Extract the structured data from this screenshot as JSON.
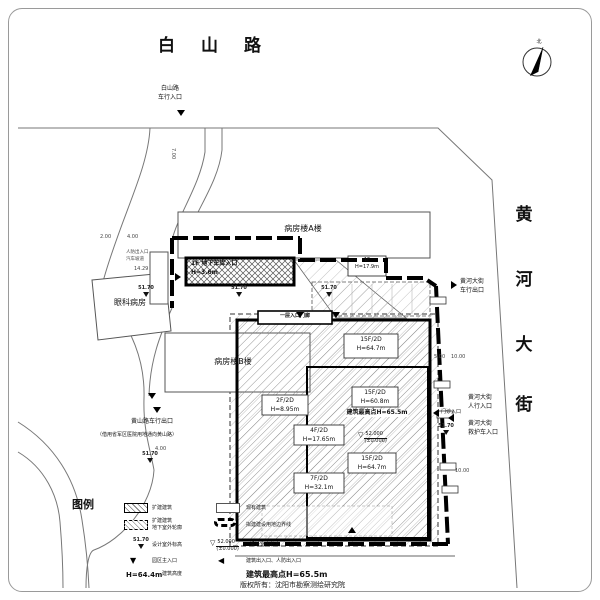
{
  "roads": {
    "baishan": "白山路",
    "huanghe": [
      "黄",
      "河",
      "大",
      "街"
    ]
  },
  "north": "北",
  "buildings": {
    "ward_a": "病房楼A楼",
    "ward_b": "病房楼B楼",
    "eye_ward": "眼科病房",
    "garage_l1": "1F 地下车库入口",
    "garage_l2": "H=3.6m",
    "podium_l1": "1F",
    "podium_l2": "H=17.9m",
    "porch": "一层入口门廊"
  },
  "annotations": {
    "t1": [
      "15F/2D",
      "H=64.7m"
    ],
    "t2": [
      "15F/2D",
      "H=60.8m",
      "建筑最高点H=65.5m"
    ],
    "t3": [
      "2F/2D",
      "H=8.95m"
    ],
    "t4": [
      "4F/2D",
      "H=17.65m"
    ],
    "t5": [
      "7F/2D",
      "H=32.1m"
    ],
    "t6": [
      "15F/2D",
      "H=64.7m"
    ]
  },
  "entrances": {
    "baishan_vehicle": [
      "白山路",
      "车行入口"
    ],
    "huanghe_exit": [
      "黄河大街",
      "车行出口"
    ],
    "outpatient": "门诊入口",
    "huanghe_ped": [
      "黄河大街",
      "人行入口"
    ],
    "huanghe_amb": [
      "黄河大街",
      "救护车入口"
    ],
    "huangshan_exit": "黄山路车行出口",
    "huangshan_note": "（借用省军区医院用地通向黄山路）"
  },
  "side_labels": {
    "ramp_l1": "人防出入口",
    "ramp_l2": "汽车坡道"
  },
  "indoor_mark": {
    "v1": "52.000",
    "v2": "(±0.000)"
  },
  "legend": {
    "title": "图例",
    "expand_label": "扩建建筑",
    "existing_label": "现有建筑",
    "underground_l1": "扩建建筑",
    "underground_l2": "地下室外轮廓",
    "boundary_label": "拟建建设用地边界线",
    "outdoor_elev_value": "51.70",
    "outdoor_elev_label": "设计室外标高",
    "indoor_elev_v1": "52.000",
    "indoor_elev_v2": "(±0.000)",
    "indoor_elev_label": "设计室内标高",
    "main_entrance_label": "园区主入口",
    "building_entrance_label": "建筑出入口、人防出入口",
    "height_value": "H=64.4m",
    "height_label": "建筑高度",
    "max_height_label": "建筑最高点H=65.5m"
  },
  "footer": "版权所有：沈阳市勘察测绘研究院",
  "dimensions": [
    {
      "v": "7.00",
      "x": 176,
      "y": 148,
      "rot": 90
    },
    {
      "v": "2.00",
      "x": 100,
      "y": 234
    },
    {
      "v": "4.00",
      "x": 127,
      "y": 234
    },
    {
      "v": "14.29",
      "x": 134,
      "y": 266
    },
    {
      "v": "5.00",
      "x": 434,
      "y": 354
    },
    {
      "v": "10.00",
      "x": 451,
      "y": 354
    },
    {
      "v": "10.00",
      "x": 455,
      "y": 468
    },
    {
      "v": "4.00",
      "x": 155,
      "y": 446
    }
  ],
  "elev_marks": [
    {
      "v": "51.70",
      "x": 146,
      "y": 286
    },
    {
      "v": "51.70",
      "x": 239,
      "y": 286
    },
    {
      "v": "51.70",
      "x": 329,
      "y": 286
    },
    {
      "v": "51.70",
      "x": 446,
      "y": 424
    },
    {
      "v": "51.70",
      "x": 150,
      "y": 452
    }
  ],
  "arrows": [
    {
      "x": 177,
      "y": 110,
      "rot": 0
    },
    {
      "x": 174,
      "y": 274,
      "rot": -90
    },
    {
      "x": 450,
      "y": 282,
      "rot": -90
    },
    {
      "x": 432,
      "y": 410,
      "rot": 90
    },
    {
      "x": 447,
      "y": 415,
      "rot": 90
    },
    {
      "x": 148,
      "y": 393,
      "rot": 0
    },
    {
      "x": 153,
      "y": 407,
      "rot": 0
    },
    {
      "x": 296,
      "y": 312,
      "rot": 0
    },
    {
      "x": 332,
      "y": 312,
      "rot": 0
    },
    {
      "x": 348,
      "y": 527,
      "rot": 180
    }
  ]
}
